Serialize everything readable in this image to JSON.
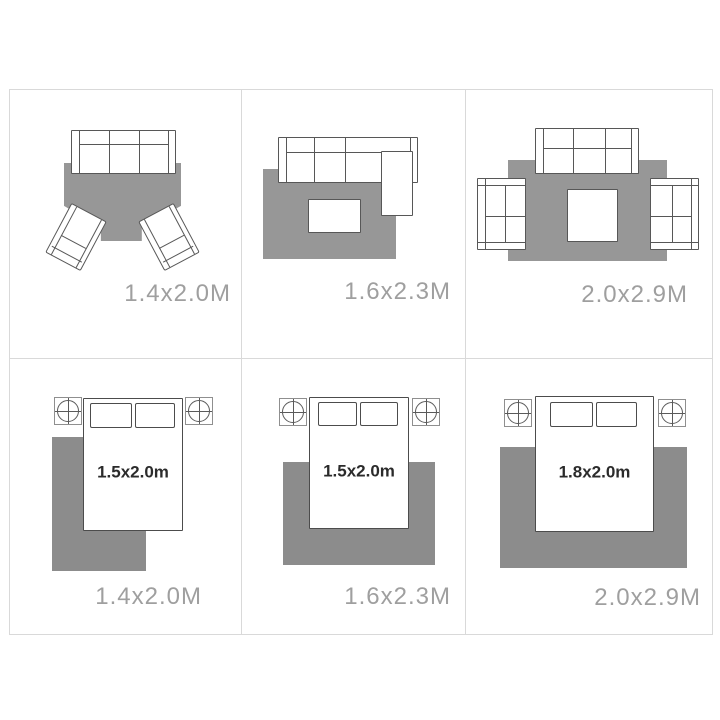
{
  "palette": {
    "background": "#ffffff",
    "grid_line": "#d9d9d9",
    "rug_gray_living": "#979797",
    "rug_gray_bedroom": "#8c8c8c",
    "furniture_outline": "#575757",
    "rug_label_color": "#9f9f9f",
    "bed_label_color": "#2b2b2b"
  },
  "cells": [
    {
      "room": "living-room",
      "rug_size_label": "1.4x2.0M"
    },
    {
      "room": "living-room",
      "rug_size_label": "1.6x2.3M"
    },
    {
      "room": "living-room",
      "rug_size_label": "2.0x2.9M"
    },
    {
      "room": "bedroom",
      "rug_size_label": "1.4x2.0M",
      "bed_size_label": "1.5x2.0m"
    },
    {
      "room": "bedroom",
      "rug_size_label": "1.6x2.3M",
      "bed_size_label": "1.5x2.0m"
    },
    {
      "room": "bedroom",
      "rug_size_label": "2.0x2.9M",
      "bed_size_label": "1.8x2.0m"
    }
  ]
}
